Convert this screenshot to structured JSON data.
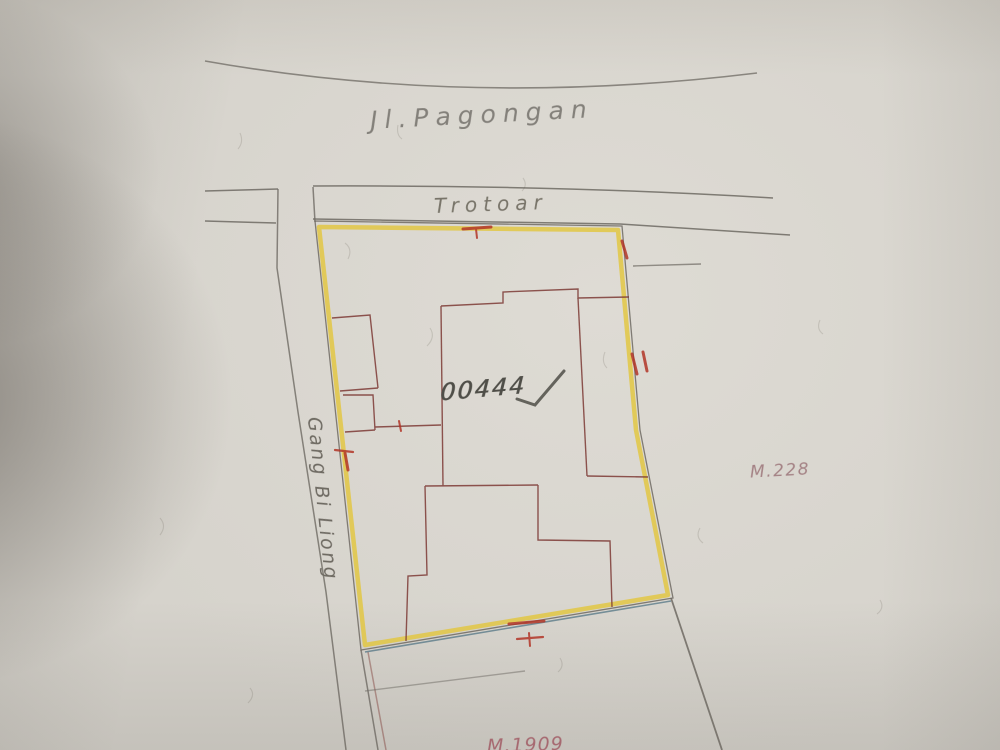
{
  "labels": {
    "road": "Jl.Pagongan",
    "sidewalk": "Trotoar",
    "alley": "Gang Bi Liong",
    "parcel_number": "00444",
    "marker_right": "M.228",
    "marker_bottom": "M.1909"
  },
  "map_features": {
    "highlighted_parcel": "parcel outlined in yellow with red survey tick marks",
    "buildings": "dark-red building outlines inside parcel",
    "sidewalk_band": "Trotoar strip along top between two survey lines",
    "alley_band": "Gang Bi Liong alley running down the left side",
    "annotation": "handwritten parcel number 00444 with pencil checkmark"
  },
  "colors": {
    "paper": "#d8d5ce",
    "highlight": "#e2c63b",
    "survey-line": "#6e6a63",
    "building-line": "#7d3a35",
    "tick-red": "#b23527",
    "teal-line": "#4a6f80",
    "pencil": "#4f4e48",
    "label-gray": "#7b776e",
    "label-maroon": "#a2616b"
  }
}
